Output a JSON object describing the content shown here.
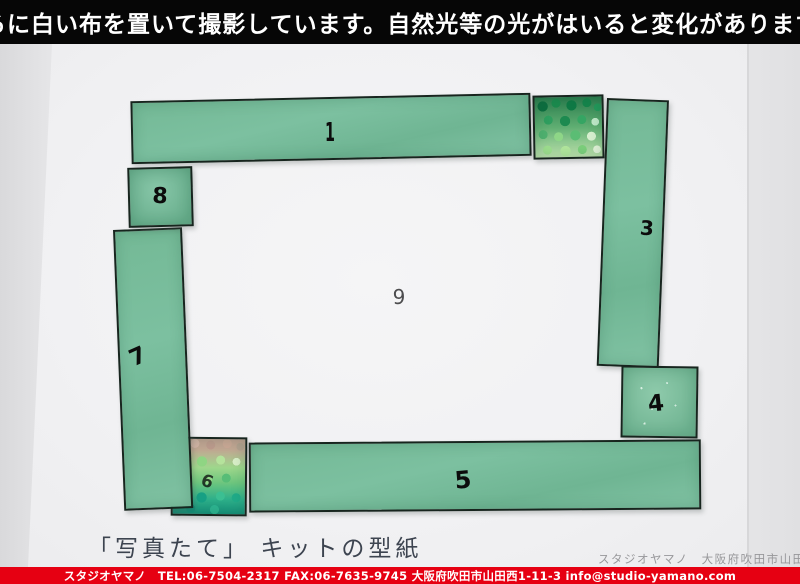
{
  "banner": {
    "text": "後ろに白い布を置いて撮影しています。自然光等の光がはいると変化があります。"
  },
  "photo": {
    "caption": "「写真たて」 キットの型紙",
    "watermark": "スタジオヤマノ　大阪府吹田市山田西1-",
    "frame": {
      "description": "green stained-glass photo frame assembled from numbered pattern pieces",
      "pieces": [
        {
          "id": 1,
          "label": "1",
          "type": "plain-glass-strip-top"
        },
        {
          "id": 2,
          "label": "",
          "type": "nugget-glass-corner-top-right"
        },
        {
          "id": 3,
          "label": "3",
          "type": "plain-glass-strip-right"
        },
        {
          "id": 4,
          "label": "4",
          "type": "plain-glass-corner-right-bottom"
        },
        {
          "id": 5,
          "label": "5",
          "type": "plain-glass-strip-bottom"
        },
        {
          "id": 6,
          "label": "6",
          "type": "nugget-glass-corner-bottom-left"
        },
        {
          "id": 7,
          "label": "7",
          "type": "plain-glass-strip-left"
        },
        {
          "id": 8,
          "label": "8",
          "type": "plain-glass-corner-top-left"
        },
        {
          "id": 9,
          "label": "9",
          "type": "paper-aperture-center"
        }
      ]
    }
  },
  "footer": {
    "text": "スタジオヤマノ　TEL:06-7504-2317 FAX:06-7635-9745 大阪府吹田市山田西1-11-3 info@studio-yamano.com"
  },
  "colors": {
    "banner_background": "#060606",
    "glass_green": "#74b996",
    "nugget_dark_green": "#0d6d3f",
    "nugget_teal": "#159079",
    "footer_red": "#e60012",
    "paper_white": "#f3f3f5",
    "cloth_gray": "#e5e5e7"
  }
}
